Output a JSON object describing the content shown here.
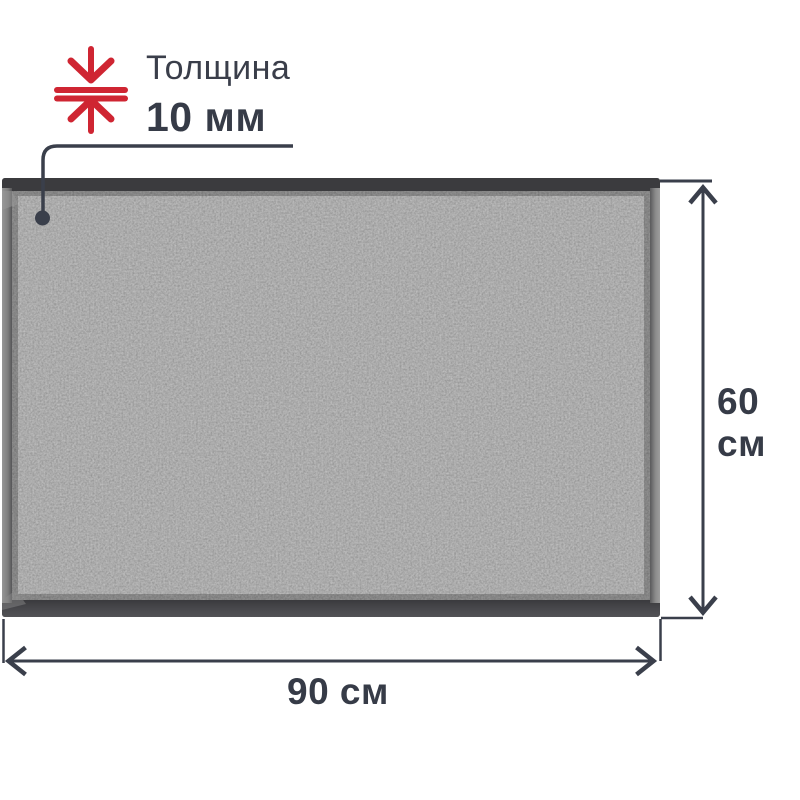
{
  "colors": {
    "accent_red": "#cf2532",
    "dimension_line": "#3a3f4b",
    "text_dark": "#363b47",
    "mat_carpet_base": "#575757",
    "mat_border_top": "#3b3b3e",
    "mat_border_bottom": "#47474b",
    "mat_border_side_light": "#8d8d8d"
  },
  "icons": {
    "thickness": "compress-vertical-arrows-icon"
  },
  "thickness_callout": {
    "label": "Толщина",
    "value": "10 мм"
  },
  "dimensions": {
    "height_label": "60 см",
    "width_label": "90 см"
  }
}
